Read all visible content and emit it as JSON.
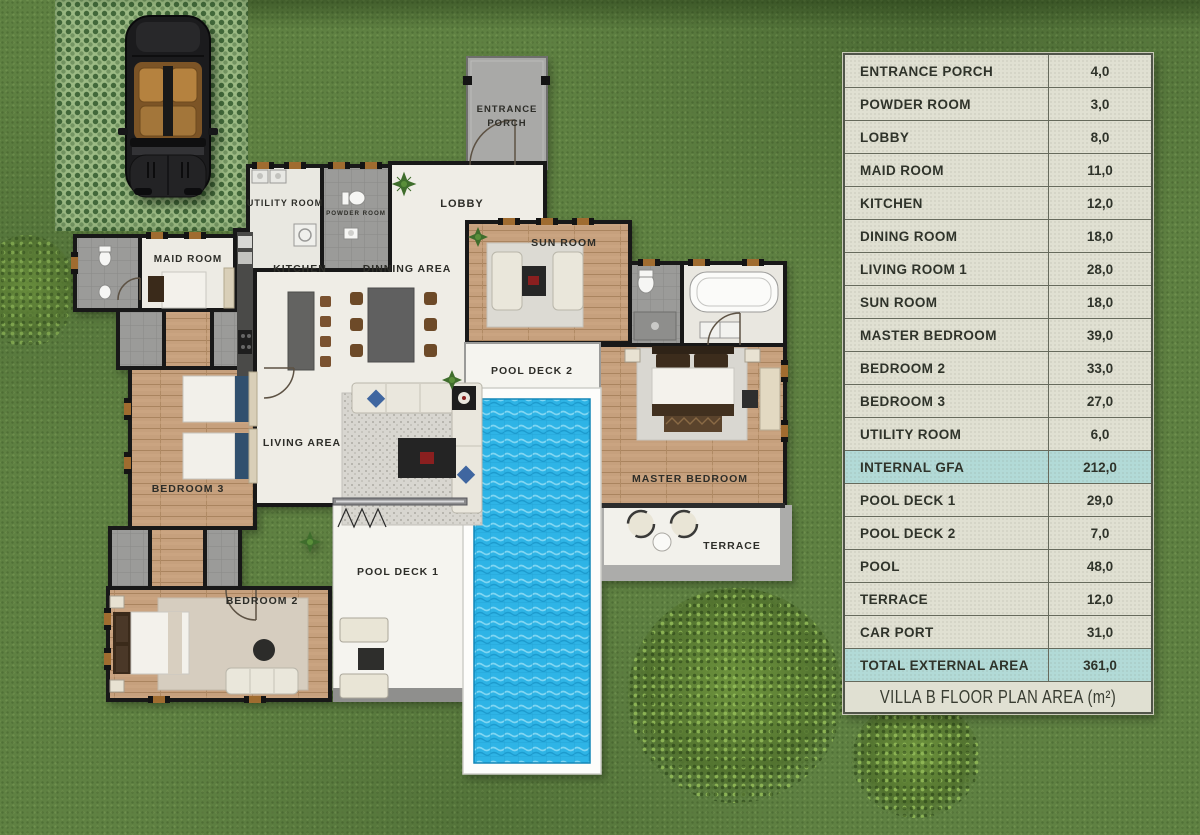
{
  "colors": {
    "grass": "#5f8142",
    "paver_light": "#9cba84",
    "paver_dot": "#42683a",
    "table_bg": "#e0e0d2",
    "table_highlight": "#b2dad7",
    "table_border": "#51554a",
    "pool_water": "#2eb4e6",
    "wood_floor": "#c6a07d",
    "wall": "#181818"
  },
  "floor_plan": {
    "rooms": {
      "entrance_porch_lines": [
        "ENTRANCE",
        "PORCH"
      ],
      "utility_room": "UTILITY ROOM",
      "powder_room": "POWDER ROOM",
      "lobby": "LOBBY",
      "maid_room": "MAID ROOM",
      "kitchen": "KITCHEN",
      "dinning_area": "DINNING AREA",
      "sun_room": "SUN ROOM",
      "living_area": "LIVING AREA",
      "pool_deck_2": "POOL DECK 2",
      "master_bedroom": "MASTER BEDROOM",
      "bedroom_3": "BEDROOM 3",
      "bedroom_2": "BEDROOM 2",
      "pool_deck_1": "POOL DECK 1",
      "terrace": "TERRACE"
    }
  },
  "area_table": {
    "rows": [
      {
        "label": "ENTRANCE PORCH",
        "value": "4,0",
        "highlight": false
      },
      {
        "label": "POWDER ROOM",
        "value": "3,0",
        "highlight": false
      },
      {
        "label": "LOBBY",
        "value": "8,0",
        "highlight": false
      },
      {
        "label": "MAID ROOM",
        "value": "11,0",
        "highlight": false
      },
      {
        "label": "KITCHEN",
        "value": "12,0",
        "highlight": false
      },
      {
        "label": "DINING  ROOM",
        "value": "18,0",
        "highlight": false
      },
      {
        "label": "LIVING ROOM 1",
        "value": "28,0",
        "highlight": false
      },
      {
        "label": "SUN ROOM",
        "value": "18,0",
        "highlight": false
      },
      {
        "label": "MASTER BEDROOM",
        "value": "39,0",
        "highlight": false
      },
      {
        "label": "BEDROOM 2",
        "value": "33,0",
        "highlight": false
      },
      {
        "label": "BEDROOM 3",
        "value": "27,0",
        "highlight": false
      },
      {
        "label": "UTILITY ROOM",
        "value": "6,0",
        "highlight": false
      },
      {
        "label": "INTERNAL GFA",
        "value": "212,0",
        "highlight": true
      },
      {
        "label": "POOL DECK 1",
        "value": "29,0",
        "highlight": false
      },
      {
        "label": "POOL DECK 2",
        "value": "7,0",
        "highlight": false
      },
      {
        "label": "POOL",
        "value": "48,0",
        "highlight": false
      },
      {
        "label": "TERRACE",
        "value": "12,0",
        "highlight": false
      },
      {
        "label": "CAR PORT",
        "value": "31,0",
        "highlight": false
      },
      {
        "label": "TOTAL EXTERNAL AREA",
        "value": "361,0",
        "highlight": true
      }
    ],
    "footer": "VILLA B FLOOR PLAN AREA (m²)"
  }
}
